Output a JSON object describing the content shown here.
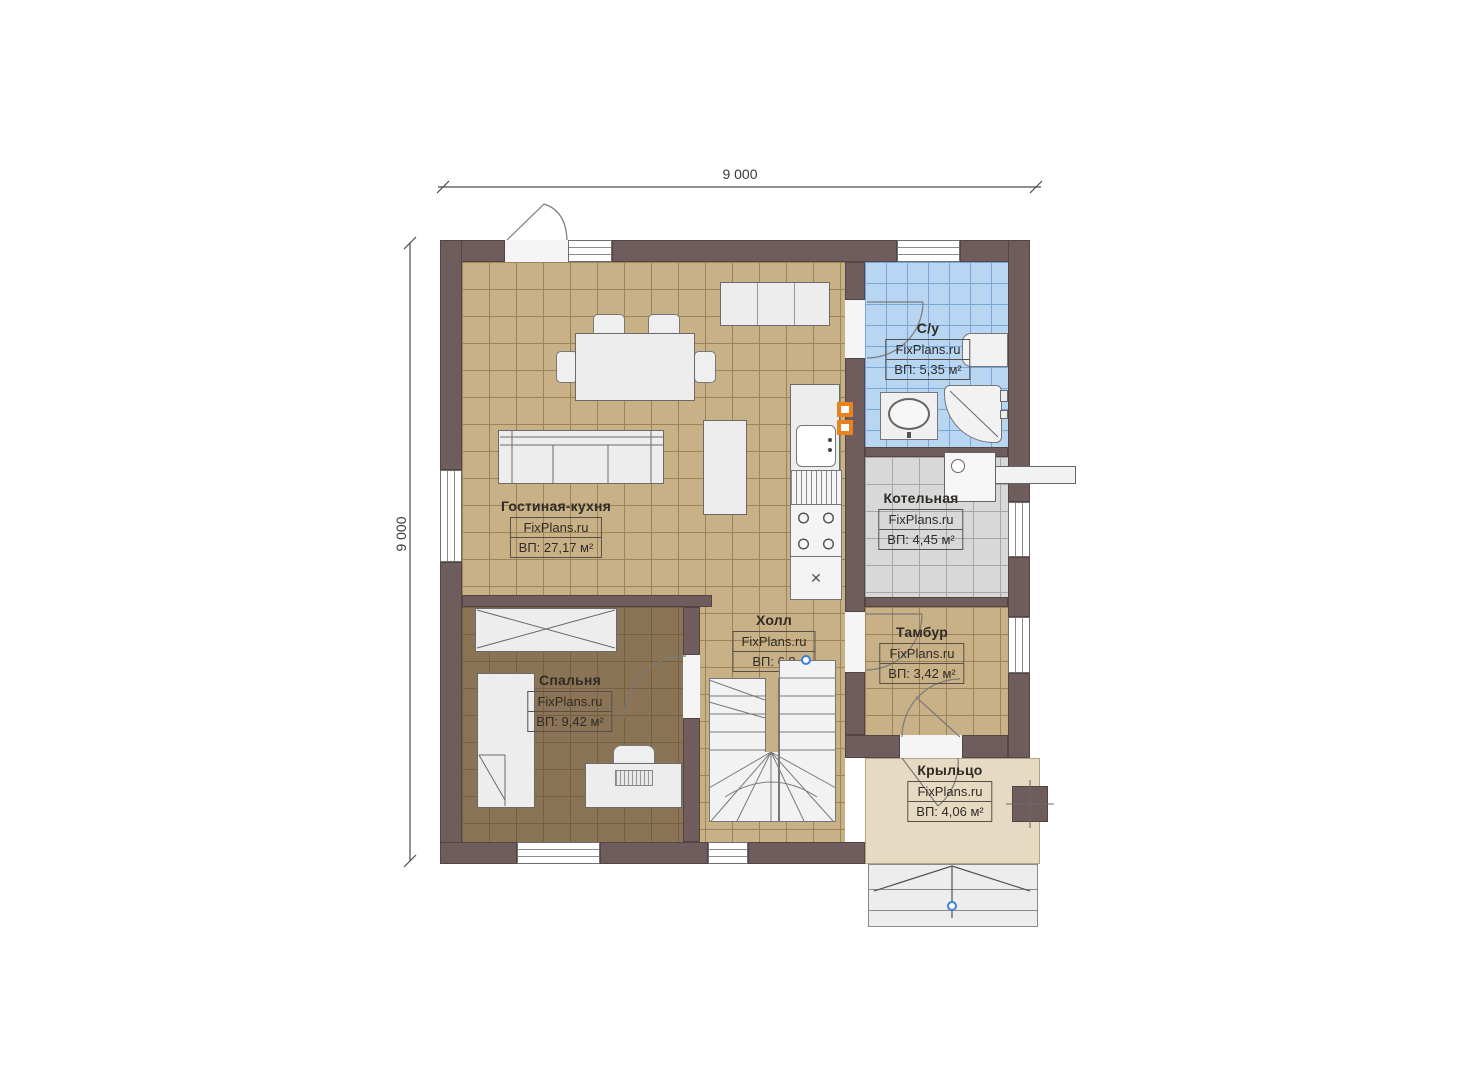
{
  "dimensions": {
    "width_label": "9 000",
    "height_label": "9 000"
  },
  "watermark": "FixPlans.ru",
  "rooms": {
    "living": {
      "name": "Гостиная-кухня",
      "area": "ВП: 27,17 м²"
    },
    "bathroom": {
      "name": "С/у",
      "area": "ВП: 5,35 м²"
    },
    "boiler": {
      "name": "Котельная",
      "area": "ВП: 4,45 м²"
    },
    "tambour": {
      "name": "Тамбур",
      "area": "ВП: 3,42 м²"
    },
    "hall": {
      "name": "Холл",
      "area": "ВП: 6,8"
    },
    "bedroom": {
      "name": "Спальня",
      "area": "ВП: 9,42 м²"
    },
    "porch": {
      "name": "Крыльцо",
      "area": "ВП: 4,06 м²"
    }
  },
  "colors": {
    "wall": "#6f5c5c",
    "floor_tan": "#c9b187",
    "floor_tan_grid": "#9c8458",
    "floor_bedroom": "#8b7456",
    "floor_bedroom_grid": "#75603f",
    "floor_bath": "#b8d5f1",
    "floor_bath_grid": "#79a6d8",
    "floor_boiler": "#d8d8d8",
    "floor_boiler_grid": "#a6a6a6",
    "floor_porch": "#e7dac2",
    "furniture": "#ededed",
    "stroke": "#6a6a6a",
    "ink": "#2f2b27",
    "accent_orange": "#e8821e",
    "marker_blue": "#3f7fd6",
    "dim": "#4a4a4a"
  }
}
